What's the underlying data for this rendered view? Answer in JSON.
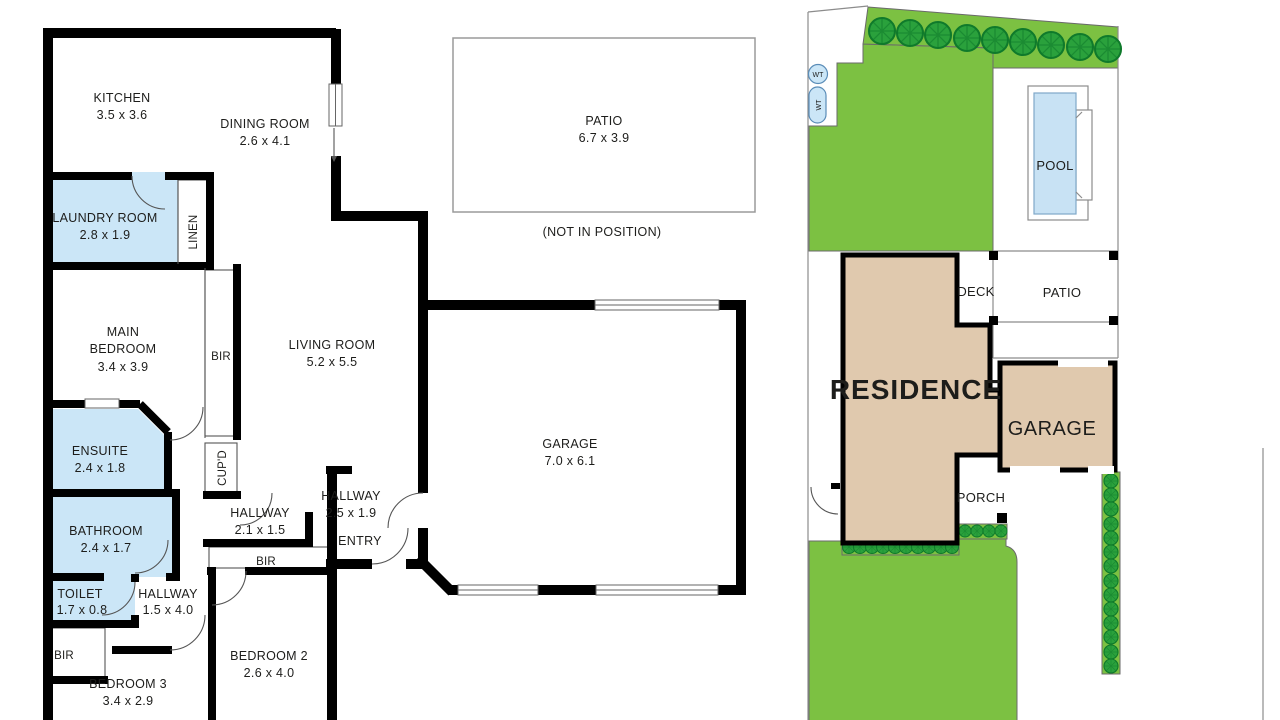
{
  "colors": {
    "wall": "#000000",
    "wet_blue": "#CBE6F7",
    "lawn_green": "#7CC142",
    "tree_green": "#2AA13C",
    "tree_outline": "#0F7A2B",
    "residence_tan": "#E0C9AE",
    "pool_blue": "#C8E2F4",
    "boundary_gray": "#8C8C8C",
    "label": "#1D1D1B"
  },
  "floor_plan": {
    "rooms": {
      "kitchen": {
        "name": "KITCHEN",
        "dims": "3.5 x 3.6"
      },
      "dining": {
        "name": "DINING ROOM",
        "dims": "2.6 x 4.1"
      },
      "laundry": {
        "name": "LAUNDRY ROOM",
        "dims": "2.8 x 1.9"
      },
      "linen": {
        "name": "LINEN"
      },
      "main_bedroom": {
        "line1": "MAIN",
        "line2": "BEDROOM",
        "dims": "3.4 x 3.9"
      },
      "bir_main": {
        "name": "BIR"
      },
      "living": {
        "name": "LIVING ROOM",
        "dims": "5.2 x 5.5"
      },
      "ensuite": {
        "name": "ENSUITE",
        "dims": "2.4 x 1.8"
      },
      "cupd": {
        "name": "CUP'D"
      },
      "bathroom": {
        "name": "BATHROOM",
        "dims": "2.4 x 1.7"
      },
      "toilet": {
        "name": "TOILET",
        "dims": "1.7 x 0.8"
      },
      "hallway_a": {
        "name": "HALLWAY",
        "dims": "2.1 x 1.5"
      },
      "hallway_b": {
        "name": "HALLWAY",
        "dims": "2.5 x 1.9"
      },
      "hallway_c": {
        "name": "HALLWAY",
        "dims": "1.5 x 4.0"
      },
      "entry": {
        "name": "ENTRY"
      },
      "bir_bed2": {
        "name": "BIR"
      },
      "bir_bed3": {
        "name": "BIR"
      },
      "bedroom2": {
        "name": "BEDROOM 2",
        "dims": "2.6 x 4.0"
      },
      "bedroom3": {
        "name": "BEDROOM 3",
        "dims": "3.4 x 2.9"
      },
      "garage": {
        "name": "GARAGE",
        "dims": "7.0 x 6.1"
      },
      "patio": {
        "name": "PATIO",
        "dims": "6.7 x 3.9",
        "note": "(NOT IN POSITION)"
      }
    }
  },
  "site_plan": {
    "labels": {
      "residence": "RESIDENCE",
      "garage": "GARAGE",
      "deck": "DECK",
      "patio": "PATIO",
      "porch": "PORCH",
      "pool": "POOL",
      "wt": "WT"
    }
  }
}
